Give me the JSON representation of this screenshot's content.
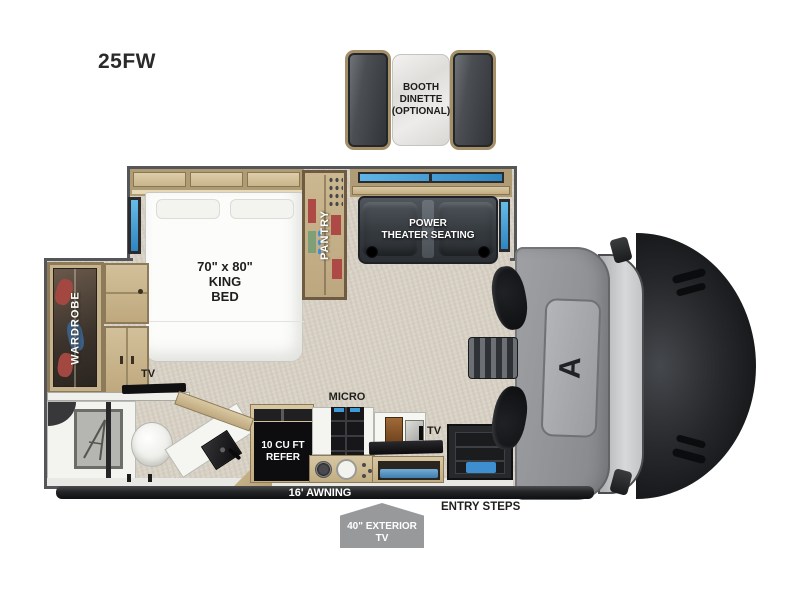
{
  "model_label": "25FW",
  "optional_dinette": {
    "line1": "BOOTH",
    "line2": "DINETTE",
    "line3": "(OPTIONAL)"
  },
  "bedroom": {
    "bed_size": "70\" x 80\"",
    "bed_type": "KING",
    "bed_word": "BED",
    "wardrobe_label": "WARDROBE",
    "pantry_label": "PANTRY",
    "tv_label": "TV"
  },
  "living": {
    "theater_line1": "POWER",
    "theater_line2": "THEATER SEATING"
  },
  "kitchen": {
    "micro_label": "MICRO",
    "refer_line1": "10 CU FT",
    "refer_line2": "REFER",
    "tv_label": "TV"
  },
  "exterior": {
    "awning_label": "16' AWNING",
    "entry_steps_label": "ENTRY STEPS",
    "exterior_tv_line1": "40\" EXTERIOR",
    "exterior_tv_line2": "TV"
  },
  "cab": {
    "logo_glyph": "A"
  },
  "colors": {
    "ink": "#1f1f1d",
    "wall": "#55565a",
    "carpet": "#d8d1c5",
    "wood": "#cdbb95",
    "wood_dark": "#8d7a58",
    "window_blue": "#3f9bd8",
    "seat": "#383d43",
    "marble": "#eae8e4",
    "red": "#ad4a45",
    "green": "#7fa077",
    "black": "#0d0d0f",
    "cab_gray": "#94969a",
    "hood": "#1b1d1f",
    "awning": "#232426",
    "sign_gray": "#97999b",
    "mat_blue": "#3d8fd0"
  }
}
